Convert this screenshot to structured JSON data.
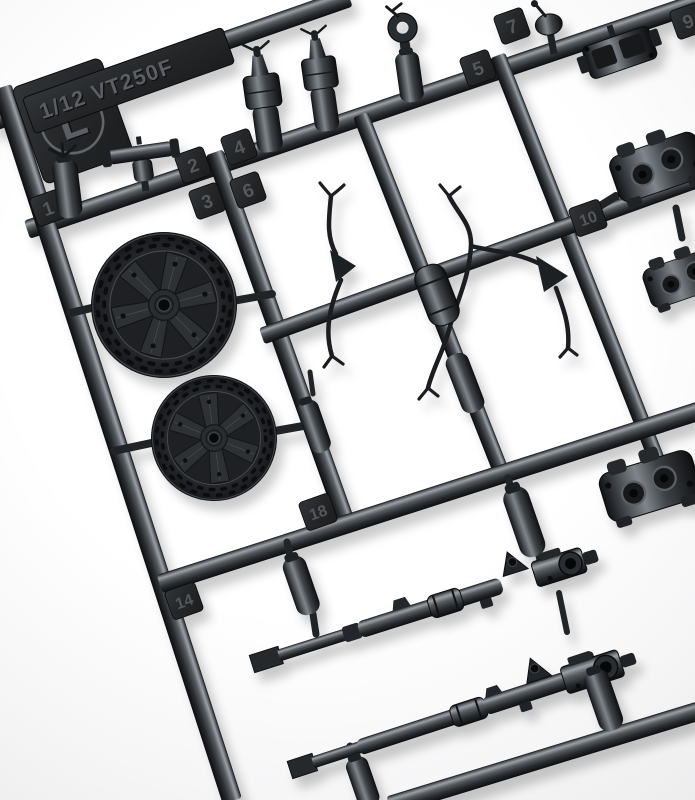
{
  "sprue": {
    "mold_letter": "L",
    "scale_marking": "1/12 VT250F",
    "part_tabs": [
      {
        "number": "1"
      },
      {
        "number": "2"
      },
      {
        "number": "3"
      },
      {
        "number": "4"
      },
      {
        "number": "5"
      },
      {
        "number": "6"
      },
      {
        "number": "7"
      },
      {
        "number": "9"
      },
      {
        "number": "10"
      },
      {
        "number": "14"
      },
      {
        "number": "18"
      }
    ],
    "colors": {
      "background": "#ffffff",
      "plastic_dark": "#121417",
      "plastic_mid": "#3c4045",
      "plastic_highlight": "#9aa0a5",
      "shadow": "#c9c9cb"
    }
  }
}
